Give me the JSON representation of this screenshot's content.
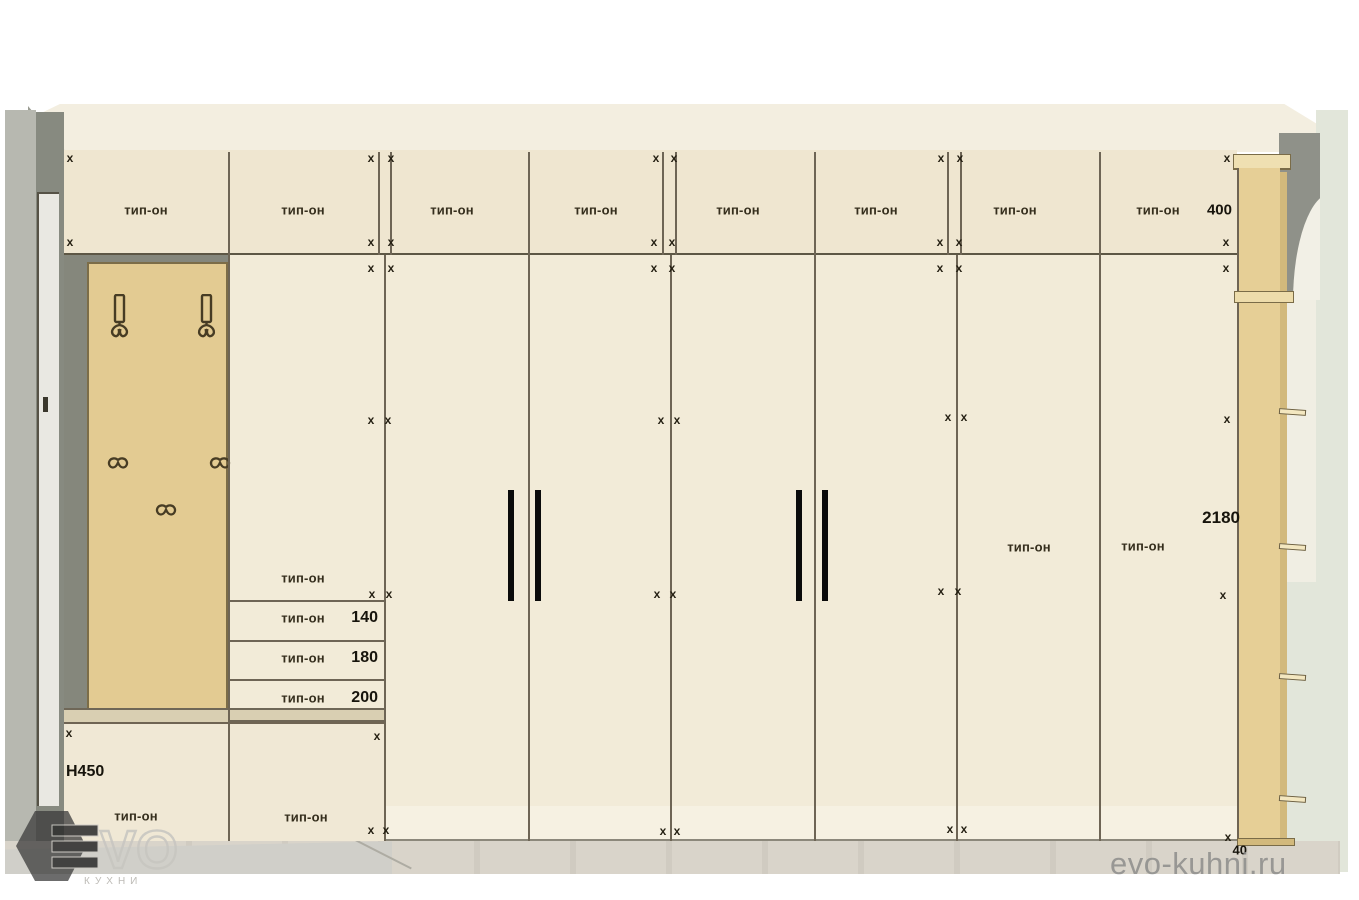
{
  "strings": {
    "cabinet_label": "тип-он",
    "site_watermark": "evo-kuhni.ru",
    "logo_vo": "VO",
    "logo_sub": "КУХНИ"
  },
  "colors": {
    "wall_top": "#f3eee0",
    "wall_right": "#e2e6da",
    "wall_dark_left": "#878a80",
    "wall_light_left": "#b7b8b0",
    "wall_dark_right": "#8f9189",
    "arch_white": "#f2f0e6",
    "cabinet_top": "#efe6d0",
    "cabinet_body": "#f2ebd8",
    "panel_tan": "#e3cb92",
    "pilaster_tan": "#e6cf96",
    "line": "#6e6555",
    "handle": "#0b0b0b",
    "text": "#352e1d",
    "watermark_gray": "#8d8d8b"
  },
  "top_cabinets": [
    {
      "label": "тип-он",
      "cx": 146
    },
    {
      "label": "тип-он",
      "cx": 303
    },
    {
      "label": "тип-он",
      "cx": 452
    },
    {
      "label": "тип-он",
      "cx": 596
    },
    {
      "label": "тип-он",
      "cx": 738
    },
    {
      "label": "тип-он",
      "cx": 876
    },
    {
      "label": "тип-он",
      "cx": 1015
    },
    {
      "label": "тип-он",
      "cx": 1158,
      "dim": "400",
      "dim_right": 1232
    }
  ],
  "tall_section_labels": [
    {
      "label": "тип-он",
      "cx": 1029,
      "cy": 547
    },
    {
      "label": "тип-он",
      "cx": 1143,
      "cy": 546
    }
  ],
  "drawer_rows": [
    {
      "label": "тип-он",
      "cy": 578
    },
    {
      "label": "тип-он",
      "value": "140",
      "cy": 618
    },
    {
      "label": "тип-он",
      "value": "180",
      "cy": 658
    },
    {
      "label": "тип-он",
      "value": "200",
      "cy": 698
    }
  ],
  "base_labels": [
    {
      "label": "тип-он",
      "cx": 136,
      "cy": 816
    },
    {
      "label": "тип-он",
      "cx": 306,
      "cy": 817
    }
  ],
  "dimensions": [
    {
      "text": "H450",
      "x": 66,
      "cy": 772,
      "align": "left",
      "size": 16
    },
    {
      "text": "2180",
      "x": 1240,
      "cy": 518,
      "align": "right",
      "size": 17
    },
    {
      "text": "40",
      "x": 1247,
      "cy": 850,
      "align": "right",
      "size": 13
    }
  ],
  "x_marks": [
    [
      70,
      158
    ],
    [
      371,
      158
    ],
    [
      391,
      158
    ],
    [
      656,
      158
    ],
    [
      674,
      158
    ],
    [
      941,
      158
    ],
    [
      960,
      158
    ],
    [
      1227,
      158
    ],
    [
      70,
      242
    ],
    [
      371,
      242
    ],
    [
      391,
      242
    ],
    [
      654,
      242
    ],
    [
      672,
      242
    ],
    [
      940,
      242
    ],
    [
      959,
      242
    ],
    [
      1226,
      242
    ],
    [
      371,
      268
    ],
    [
      391,
      268
    ],
    [
      654,
      268
    ],
    [
      672,
      268
    ],
    [
      940,
      268
    ],
    [
      959,
      268
    ],
    [
      1226,
      268
    ],
    [
      371,
      420
    ],
    [
      388,
      420
    ],
    [
      661,
      420
    ],
    [
      677,
      420
    ],
    [
      948,
      417
    ],
    [
      964,
      417
    ],
    [
      1227,
      419
    ],
    [
      372,
      594
    ],
    [
      389,
      594
    ],
    [
      657,
      594
    ],
    [
      673,
      594
    ],
    [
      941,
      591
    ],
    [
      958,
      591
    ],
    [
      1223,
      595
    ],
    [
      69,
      733
    ],
    [
      377,
      736
    ],
    [
      371,
      830
    ],
    [
      386,
      830
    ],
    [
      663,
      831
    ],
    [
      677,
      831
    ],
    [
      950,
      829
    ],
    [
      964,
      829
    ],
    [
      1228,
      837
    ]
  ]
}
